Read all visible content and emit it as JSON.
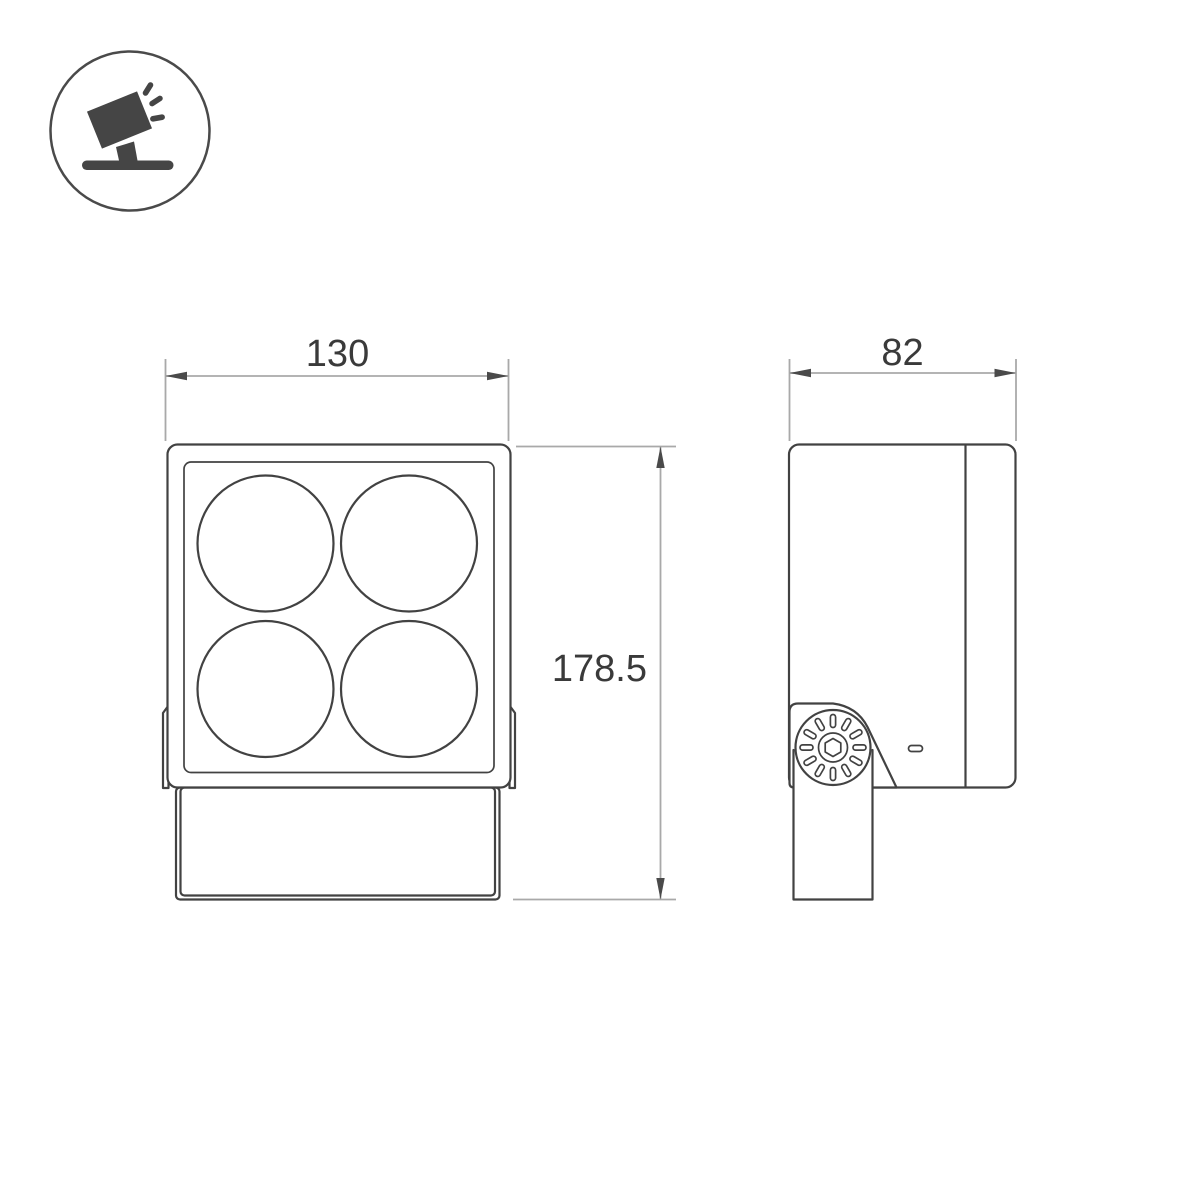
{
  "dimensions": {
    "front_width": "130",
    "overall_height": "178.5",
    "side_depth": "82"
  },
  "icon": {
    "name": "tilted-floodlight-on-stand"
  },
  "colors": {
    "bg": "#ffffff",
    "outline": "#424242",
    "dimension": "#a9a9a9",
    "arrow": "#4a4a4a",
    "text": "#3a3a3a",
    "icon": "#454545"
  }
}
